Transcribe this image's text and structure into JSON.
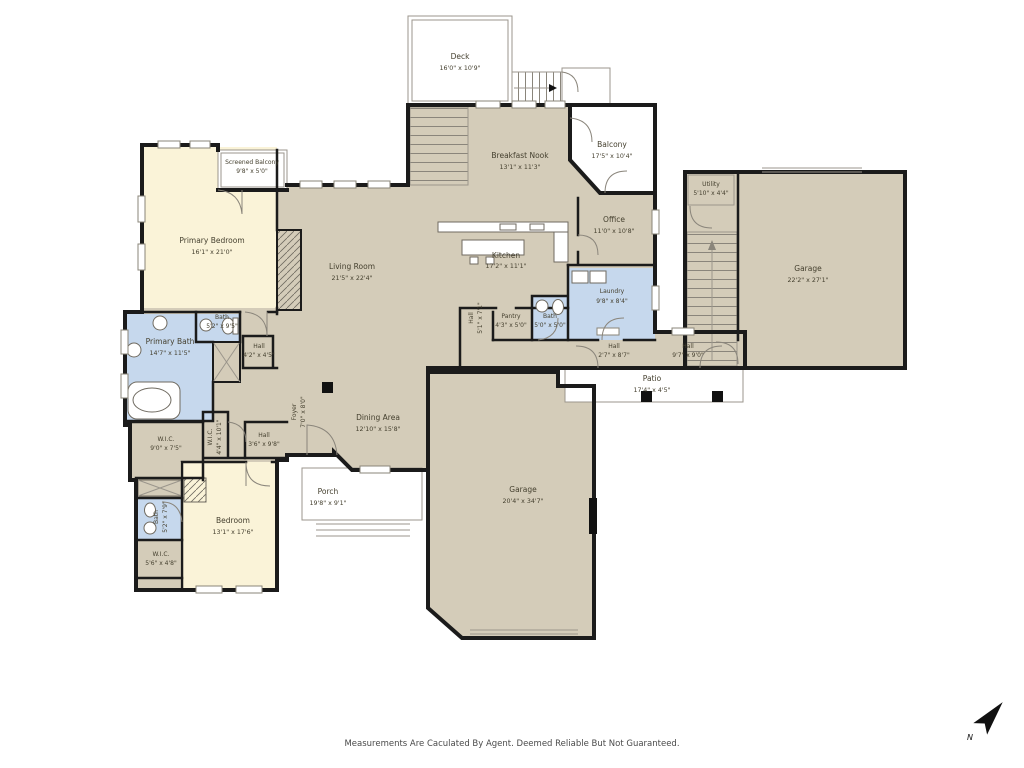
{
  "page": {
    "footer_disclaimer": "Measurements Are Caculated By Agent. Deemed Reliable But Not Guaranteed.",
    "compass_label": "N"
  },
  "colors": {
    "floor": "#d4ccb9",
    "bedroom": "#faf3d8",
    "bath": "#c6d8ed",
    "wall": "#1b1b1b",
    "outdoor_outline": "#9b968c",
    "label_text": "#45402f"
  },
  "rooms": [
    {
      "name": "Deck",
      "dims": "16'0\" x 10'9\""
    },
    {
      "name": "Screened Balcony",
      "dims": "9'8\" x 5'0\""
    },
    {
      "name": "Primary Bedroom",
      "dims": "16'1\" x 21'0\""
    },
    {
      "name": "Breakfast Nook",
      "dims": "13'1\" x 11'3\""
    },
    {
      "name": "Balcony",
      "dims": "17'5\" x 10'4\""
    },
    {
      "name": "Office",
      "dims": "11'0\" x 10'8\""
    },
    {
      "name": "Living Room",
      "dims": "21'5\" x 22'4\""
    },
    {
      "name": "Kitchen",
      "dims": "17'2\" x 11'1\""
    },
    {
      "name": "Laundry",
      "dims": "9'8\" x 8'4\""
    },
    {
      "name": "Bath",
      "dims": "5'0\" x 5'0\""
    },
    {
      "name": "Hall",
      "dims": "5'1\" x 7'1\""
    },
    {
      "name": "Pantry",
      "dims": "4'3\" x 5'0\""
    },
    {
      "name": "Utility",
      "dims": "5'10\" x 4'4\""
    },
    {
      "name": "Garage",
      "dims": "22'2\" x 27'1\""
    },
    {
      "name": "Hall",
      "dims": "2'7\" x 8'7\""
    },
    {
      "name": "Hall",
      "dims": "9'7\" x 9'0\""
    },
    {
      "name": "Patio",
      "dims": "17'4\" x 4'5\""
    },
    {
      "name": "Foyer",
      "dims": "7'0\" x 8'0\""
    },
    {
      "name": "Dining Area",
      "dims": "12'10\" x 15'8\""
    },
    {
      "name": "Porch",
      "dims": "19'8\" x 9'1\""
    },
    {
      "name": "Garage",
      "dims": "20'4\" x 34'7\""
    },
    {
      "name": "Bedroom",
      "dims": "13'1\" x 17'6\""
    },
    {
      "name": "Bath",
      "dims": "5'2\" x 7'9\""
    },
    {
      "name": "W.I.C.",
      "dims": "5'6\" x 4'8\""
    },
    {
      "name": "Primary Bath",
      "dims": "14'7\" x 11'5\""
    },
    {
      "name": "Bath",
      "dims": "5'2\" x 9'5\""
    },
    {
      "name": "Hall",
      "dims": "4'2\" x 4'5\""
    },
    {
      "name": "W.I.C.",
      "dims": "4'4\" x 10'1\""
    },
    {
      "name": "W.I.C.",
      "dims": "9'0\" x 7'5\""
    },
    {
      "name": "Hall",
      "dims": "3'6\" x 9'8\""
    }
  ]
}
